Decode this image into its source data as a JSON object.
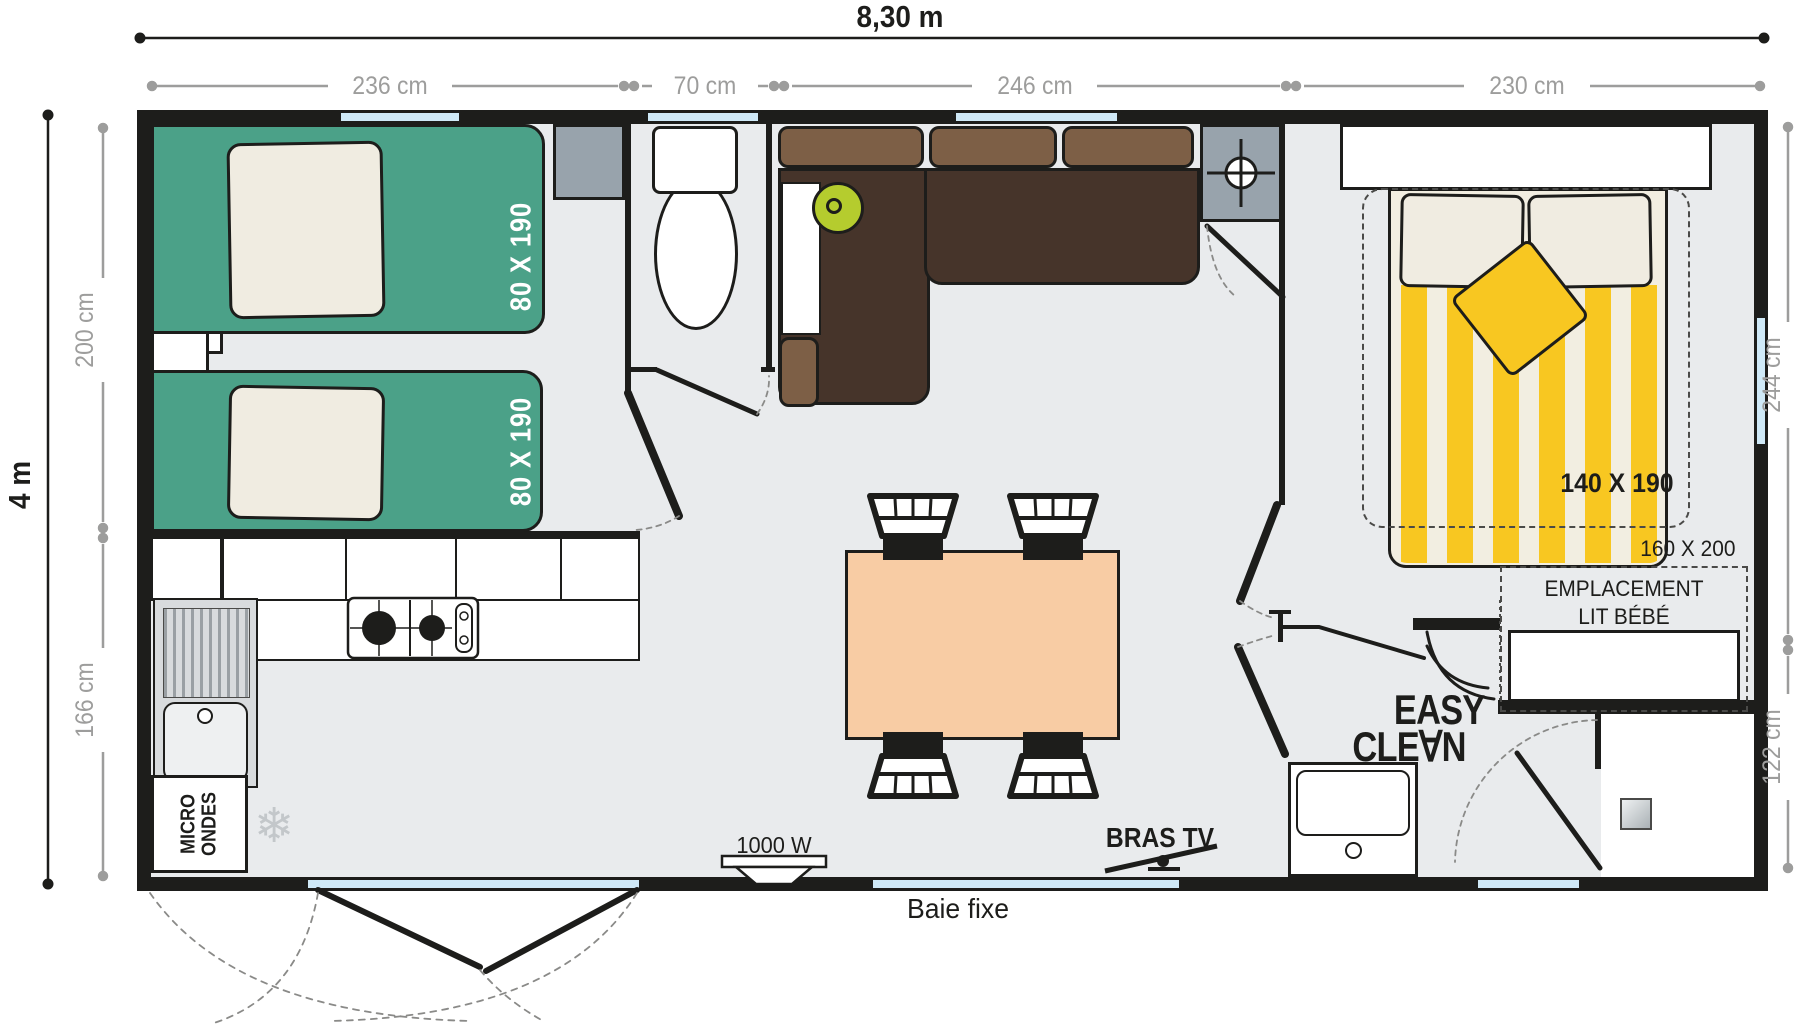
{
  "plan": {
    "type": "floor-plan",
    "title_width": "8,30 m",
    "title_height": "4 m",
    "top_segments": [
      "236 cm",
      "70 cm",
      "246 cm",
      "230 cm"
    ],
    "left_segments": [
      "200 cm",
      "166 cm"
    ],
    "right_segments": [
      "244 cm",
      "122 cm"
    ]
  },
  "labels": {
    "bed_twin_1": "80 X 190",
    "bed_twin_2": "80 X 190",
    "bed_master": "140 X 190",
    "bed_master_alt": "160 X 200",
    "baby_zone_line1": "EMPLACEMENT",
    "baby_zone_line2": "LIT BÉBÉ",
    "microwave_line1": "MICRO",
    "microwave_line2": "ONDES",
    "heater": "1000 W",
    "tv_bracket": "BRAS TV",
    "fixed_bay": "Baie fixe",
    "brand_line1": "EASY",
    "brand_line2": "CLE∀N"
  },
  "icons": {
    "fridge": "snowflake-icon",
    "water_heater": "crosshair-icon",
    "snowflake_glyph": "❄"
  },
  "colors": {
    "wall": "#1d1d1b",
    "floor": "#e9ebed",
    "dimension_gray": "#9d9d9c",
    "bed_green": "#4ba188",
    "pillow_cream": "#f0ece1",
    "sofa_dark": "#46342a",
    "sofa_light": "#7d5f46",
    "lime_accent": "#b5cc2e",
    "table_peach": "#f8cca4",
    "duvet_yellow": "#f8c721",
    "duvet_cream": "#f2eee1",
    "window_blue": "#cfe9f7",
    "cabinet_gray": "#98a3ac"
  }
}
